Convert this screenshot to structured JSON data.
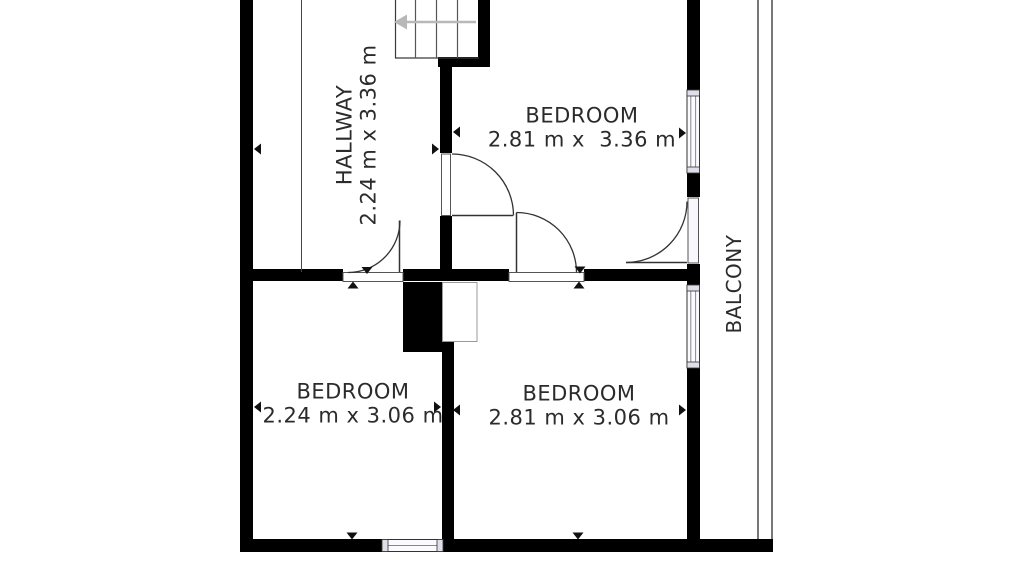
{
  "plan": {
    "type": "floor-plan",
    "rooms": {
      "hallway": {
        "name": "HALLWAY",
        "dims": "2.24 m x 3.36 m"
      },
      "bedroom_top": {
        "name": "BEDROOM",
        "dims": "2.81 m x  3.36 m"
      },
      "bedroom_bottom_left": {
        "name": "BEDROOM",
        "dims": "2.24 m x 3.06 m"
      },
      "bedroom_bottom_right": {
        "name": "BEDROOM",
        "dims": "2.81 m x 3.06 m"
      },
      "balcony": {
        "name": "BALCONY"
      }
    },
    "colors": {
      "wall": "#000000",
      "text": "#2b2b2b",
      "door_arc": "#333333",
      "stair_arrow": "#b8b8b8",
      "balcony_railing": "#555555",
      "window_frame": "#333333",
      "background": "#ffffff"
    }
  }
}
